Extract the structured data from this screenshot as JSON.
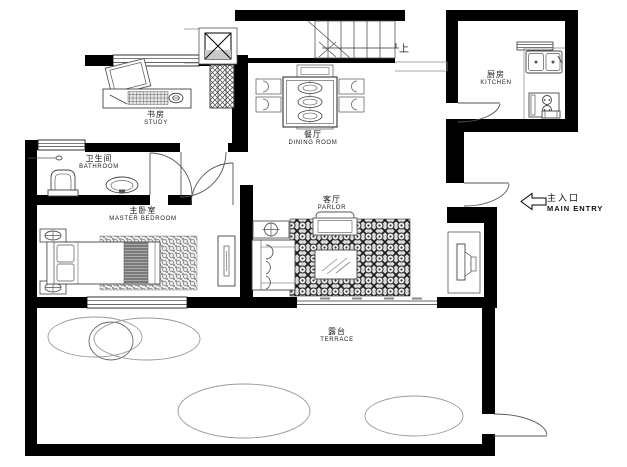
{
  "plan_title": "residential floor plan",
  "rooms": {
    "study": {
      "zh": "书房",
      "en": "STUDY"
    },
    "bathroom": {
      "zh": "卫生间",
      "en": "BATHROOM"
    },
    "master_bedroom": {
      "zh": "主卧室",
      "en": "MASTER BEDROOM"
    },
    "dining_room": {
      "zh": "餐厅",
      "en": "DINING ROOM"
    },
    "parlor": {
      "zh": "客厅",
      "en": "PARLOR"
    },
    "kitchen": {
      "zh": "厨房",
      "en": "KITCHEN"
    },
    "terrace": {
      "zh": "露台",
      "en": "TERRACE"
    }
  },
  "annotations": {
    "stairs_up": "上",
    "main_entry": {
      "zh": "主入口",
      "en": "MAIN ENTRY"
    }
  },
  "colors": {
    "wall": "#000000",
    "furniture_line": "#555555",
    "background": "#ffffff",
    "elevator_shade": "#c9c9c9",
    "blanket": "#7a7a7a"
  }
}
